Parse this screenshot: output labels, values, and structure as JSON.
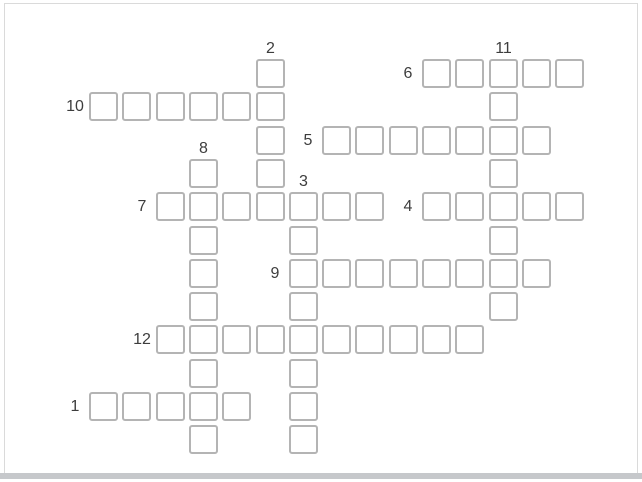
{
  "puzzle": {
    "type": "crossword",
    "grid": {
      "cols": 15,
      "rows": 12,
      "origin_x": 89,
      "origin_y": 59,
      "stride": 33.3,
      "cell_size": 29
    },
    "entries": [
      {
        "number": "1",
        "direction": "across",
        "row": 10,
        "col": 0,
        "length": 5
      },
      {
        "number": "2",
        "direction": "down",
        "row": 0,
        "col": 5,
        "length": 5
      },
      {
        "number": "3",
        "direction": "down",
        "row": 4,
        "col": 6,
        "length": 8
      },
      {
        "number": "4",
        "direction": "across",
        "row": 4,
        "col": 10,
        "length": 5
      },
      {
        "number": "5",
        "direction": "across",
        "row": 2,
        "col": 7,
        "length": 7
      },
      {
        "number": "6",
        "direction": "across",
        "row": 0,
        "col": 10,
        "length": 5
      },
      {
        "number": "7",
        "direction": "across",
        "row": 4,
        "col": 2,
        "length": 7
      },
      {
        "number": "8",
        "direction": "down",
        "row": 3,
        "col": 3,
        "length": 9
      },
      {
        "number": "9",
        "direction": "across",
        "row": 6,
        "col": 6,
        "length": 8
      },
      {
        "number": "10",
        "direction": "across",
        "row": 1,
        "col": 0,
        "length": 6
      },
      {
        "number": "11",
        "direction": "down",
        "row": 0,
        "col": 12,
        "length": 8
      },
      {
        "number": "12",
        "direction": "across",
        "row": 8,
        "col": 2,
        "length": 10
      }
    ],
    "colors": {
      "background": "#ffffff",
      "cell_fill": "#ffffff",
      "cell_border": "#b4b4b4",
      "label_text": "#3d3d3d",
      "frame_border": "#dadada",
      "bottom_bar": "#c6c8cb"
    }
  }
}
